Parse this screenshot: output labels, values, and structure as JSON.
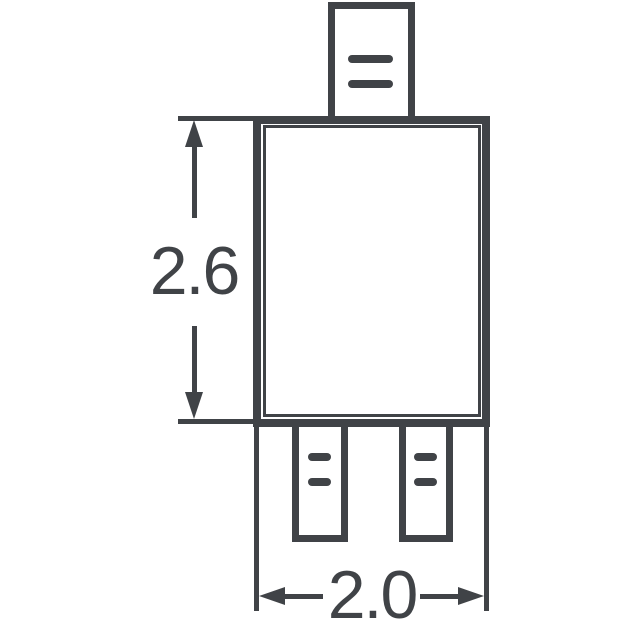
{
  "drawing": {
    "description": "component-package-outline-dimension-drawing",
    "colors": {
      "line": "#404347",
      "background": "#ffffff"
    },
    "dimensions": {
      "vertical": {
        "label": "2.6"
      },
      "horizontal": {
        "label": "2.0"
      }
    }
  }
}
